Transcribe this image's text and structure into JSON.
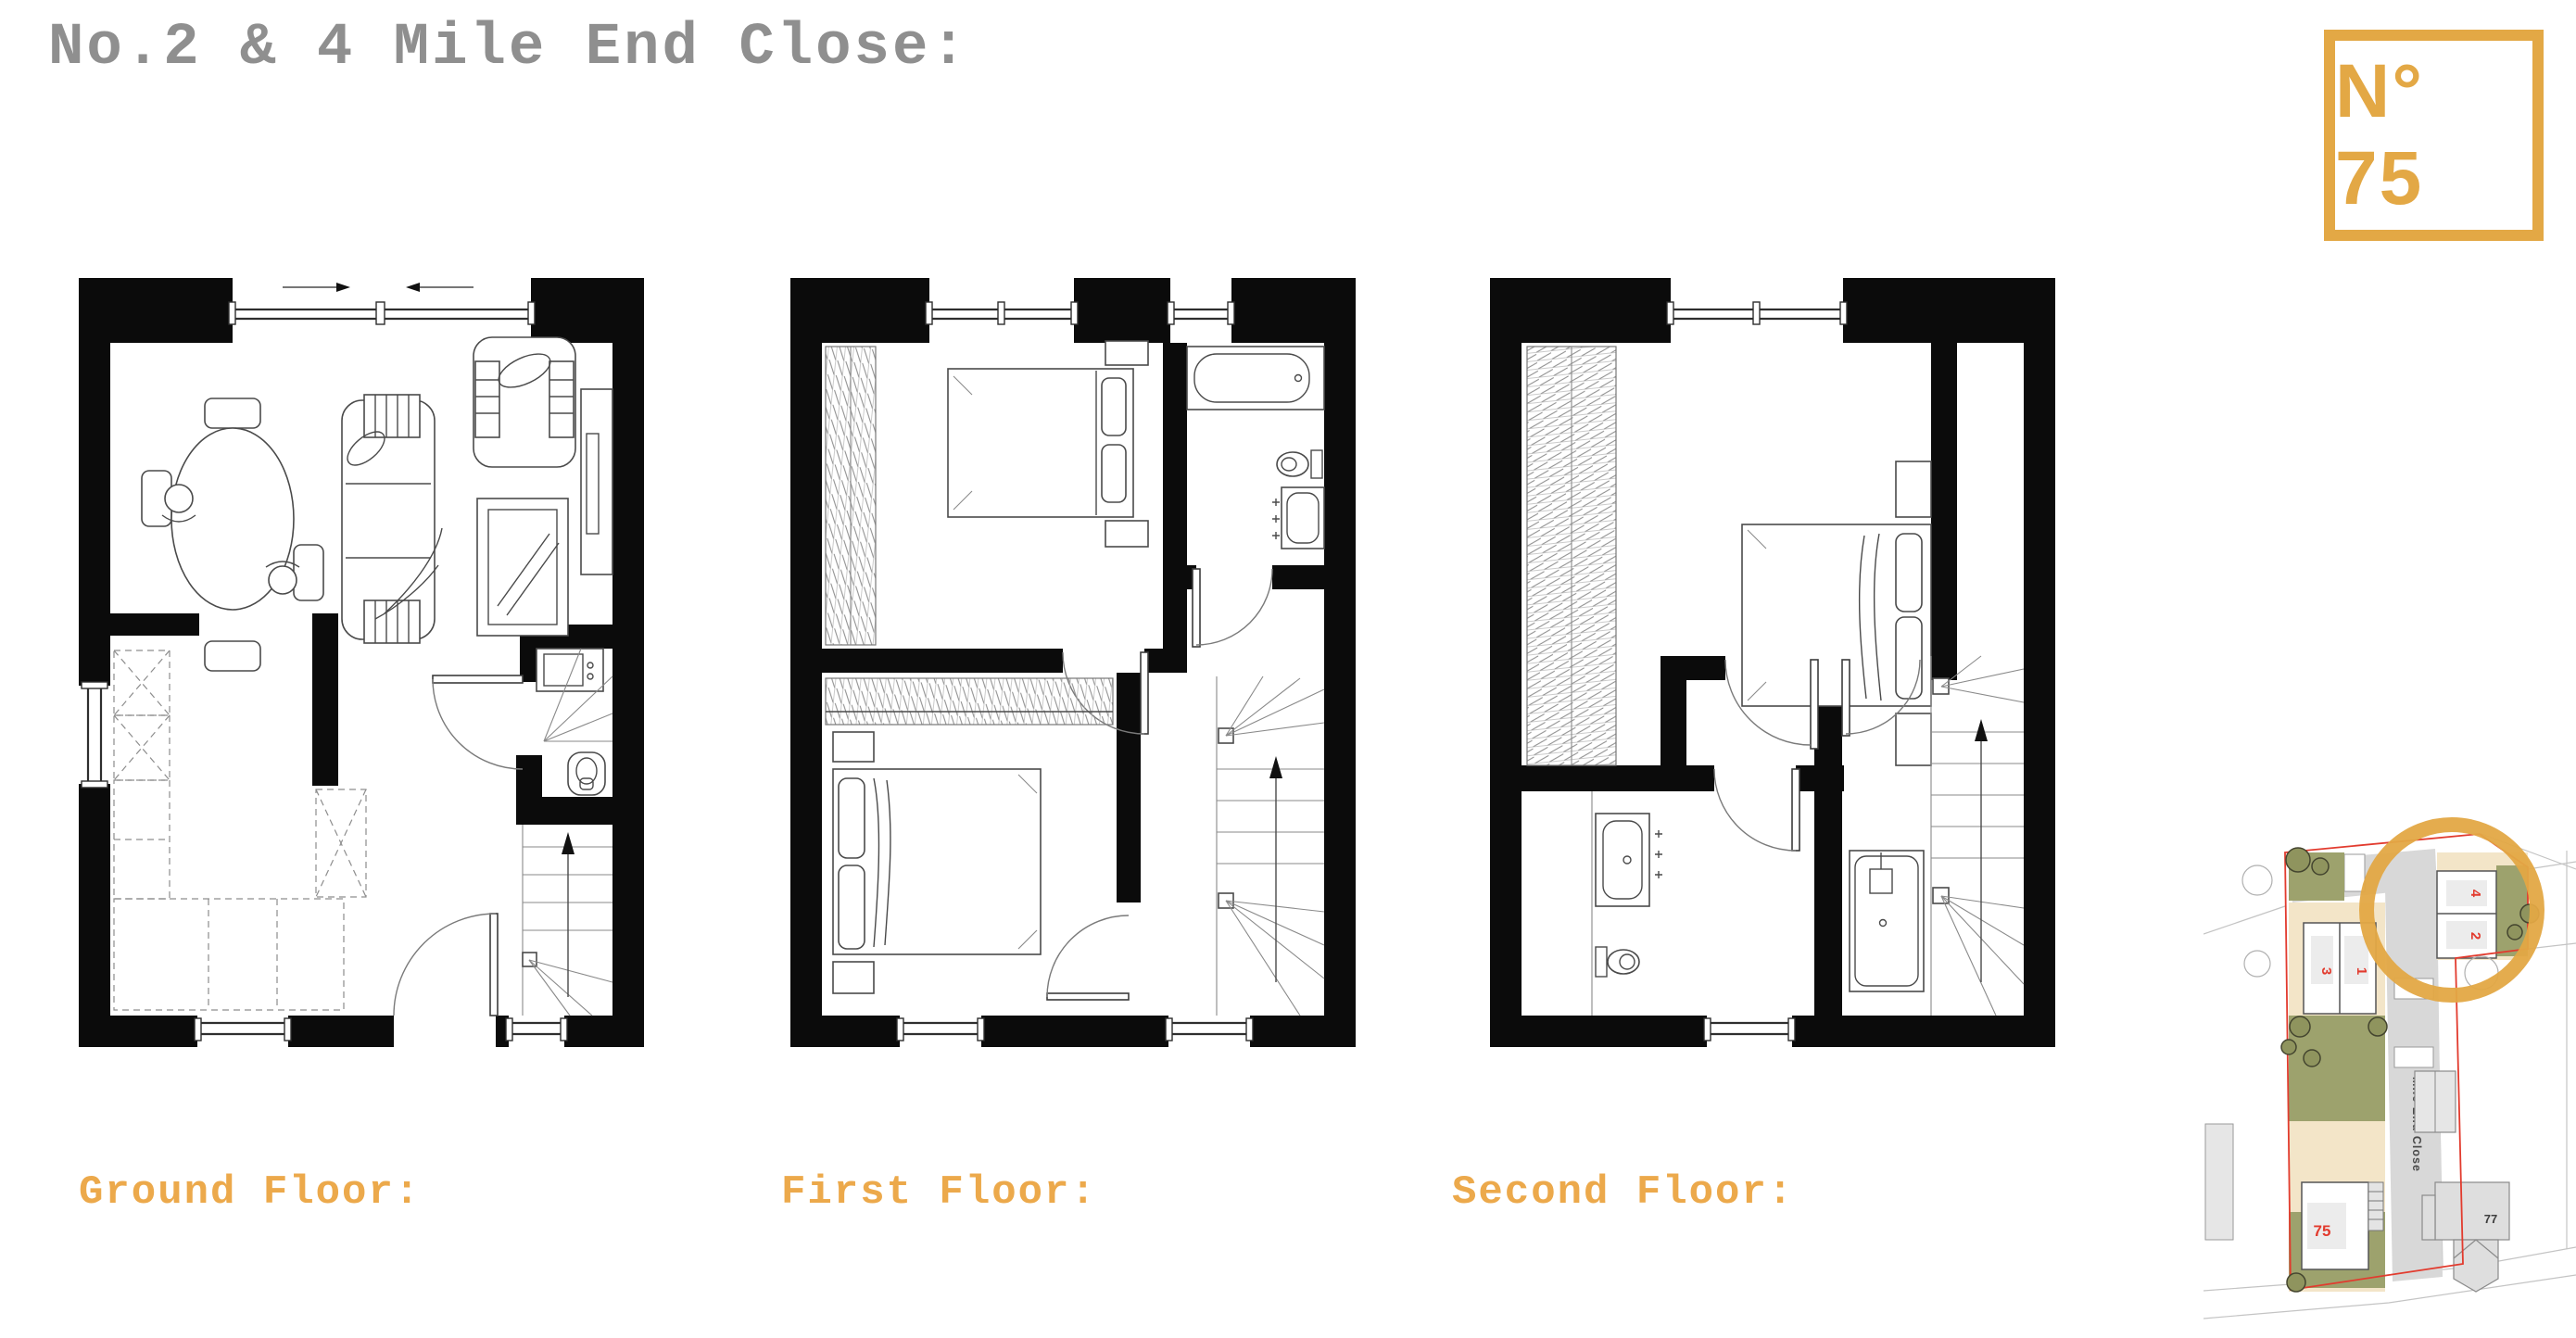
{
  "title": "No.2 & 4 Mile End Close:",
  "logo": {
    "label": "N° 75"
  },
  "floors": [
    {
      "label": "Ground Floor:"
    },
    {
      "label": "First Floor:"
    },
    {
      "label": "Second Floor:"
    }
  ],
  "site_plan": {
    "street_label": "Mile End Close",
    "plots": [
      {
        "number": "4"
      },
      {
        "number": "2"
      },
      {
        "number": "3"
      },
      {
        "number": "1"
      },
      {
        "number": "75"
      },
      {
        "number": "77"
      }
    ]
  },
  "colors": {
    "gold": "#E3A845",
    "label_gold": "#ECA94B",
    "title_grey": "#8F8F8F",
    "plot_red": "#E23B2E",
    "garden_green": "#9DA26D",
    "plot_beige": "#F3E5C8",
    "road_grey": "#D8D8D8",
    "wall_black": "#0B0B0B"
  }
}
